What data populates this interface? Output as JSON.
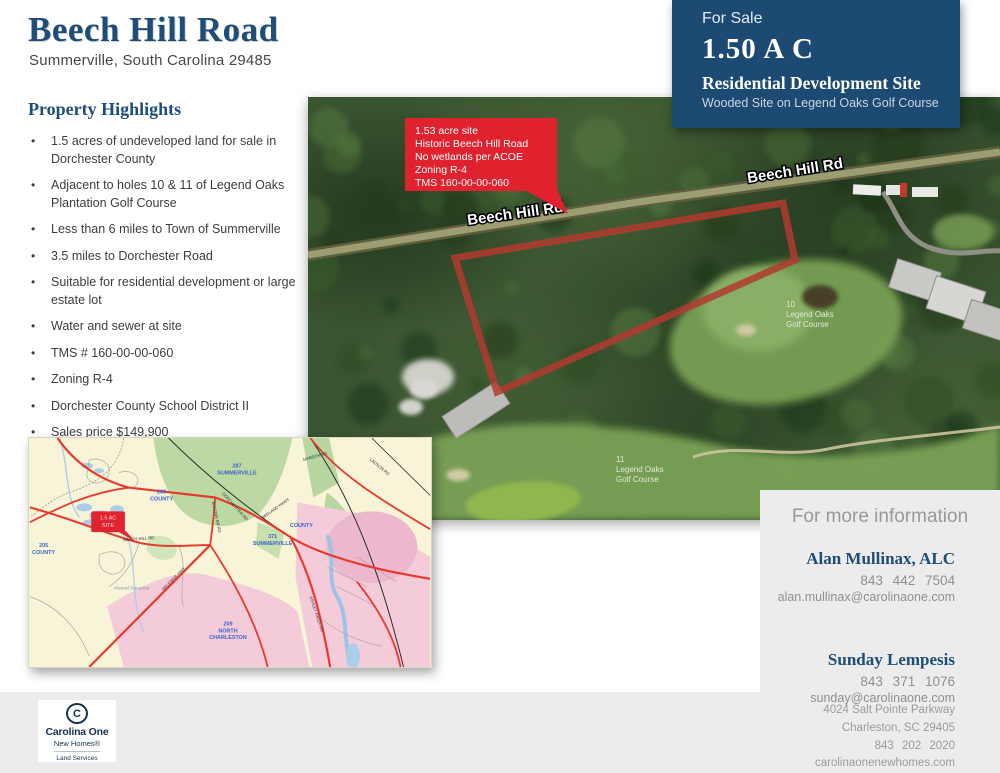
{
  "page": {
    "bg": "#ffffff",
    "accent_navy": "#1c4a72",
    "accent_red": "#e0232e"
  },
  "header": {
    "title": "Beech Hill Road",
    "subtitle": "Summerville, South Carolina 29485"
  },
  "for_sale": {
    "label": "For Sale",
    "acreage": "1.50 A C",
    "site_type": "Residential Development Site",
    "descriptor": "Wooded Site on Legend Oaks Golf Course"
  },
  "highlights": {
    "heading": "Property Highlights",
    "items": [
      "1.5 acres of undeveloped land for sale in Dorchester County",
      "Adjacent to holes 10 & 11 of Legend Oaks Plantation Golf Course",
      "Less than 6 miles to Town of Summerville",
      "3.5 miles to Dorchester Road",
      "Suitable for residential development or large estate lot",
      "Water and sewer at site",
      "TMS # 160-00-00-060",
      "Zoning R-4",
      "Dorchester County School District II",
      "Sales price $149,900"
    ]
  },
  "aerial": {
    "callout_lines": [
      "1.53 acre site",
      "Historic Beech Hill Road",
      "No wetlands per ACOE",
      "Zoning R-4",
      "TMS 160-00-00-060"
    ],
    "road_label_left": "Beech Hill Rd",
    "road_label_right": "Beech Hill Rd",
    "golf_labels": [
      {
        "hole": "10",
        "line1": "Legend Oaks",
        "line2": "Golf Course"
      },
      {
        "hole": "11",
        "line1": "Legend Oaks",
        "line2": "Golf Course"
      }
    ]
  },
  "map": {
    "site_callout": {
      "line1": "1.5 AC",
      "line2": "SITE"
    },
    "area_labels": {
      "num_287": "287",
      "summerville_a": "SUMMERVILLE",
      "num_208": "208",
      "county_a": "COUNTY",
      "num_371": "371",
      "summerville_b": "SUMMERVILLE",
      "num_205": "205",
      "county_b": "COUNTY",
      "num_209": "209",
      "north": "NORTH",
      "charleston": "CHARLESTON",
      "county_c": "COUNTY",
      "round_savanna": "Round Savanna"
    },
    "road_labels": {
      "beech_hill": "BEECH HILL RD",
      "delemar": "DELEMAR HWY",
      "ashley_river": "ASHLEY RIVER RD",
      "dorchester": "DORCHESTER RD",
      "midland": "MIDLAND PKWY",
      "jamison": "JAMISON RD",
      "ladson": "LADSON RD",
      "bacons": "BACONS BR RD"
    }
  },
  "contact": {
    "heading": "For more information",
    "agents": [
      {
        "name": "Alan Mullinax, ALC",
        "phone": "843 442 7504",
        "email": "alan.mullinax@carolinaone.com"
      },
      {
        "name": "Sunday Lempesis",
        "phone": "843 371 1076",
        "email": "sunday@carolinaone.com"
      }
    ],
    "office": {
      "address_line1": "4024 Salt Pointe Parkway",
      "address_line2": "Charleston, SC 29405",
      "phone": "843 202 2020",
      "website": "carolinaonenewhomes.com"
    }
  },
  "logo": {
    "c_mark": "C",
    "brand": "Carolina One",
    "sub_brand": "New Homes®",
    "division": "Land Services"
  }
}
